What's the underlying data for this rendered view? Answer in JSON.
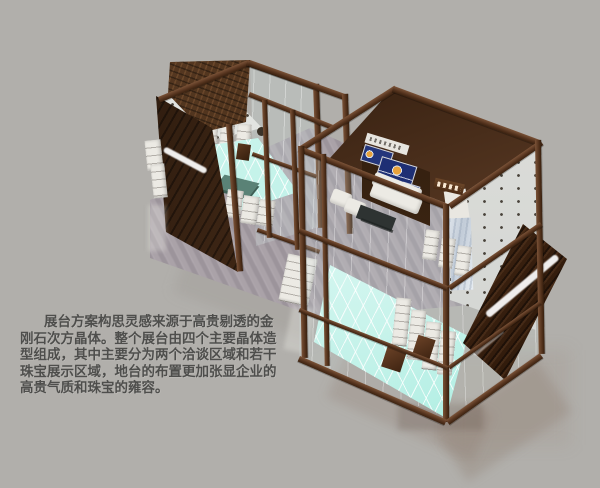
{
  "page": {
    "background": "#b1afab"
  },
  "caption": {
    "color": "#4e4e4c",
    "lines": [
      "展台方案构思灵感来源于高贵剔透的金",
      "刚石次方晶体。整个展台由四个主要晶体造",
      "型组成，其中主要分为两个洽谈区域和若干",
      "珠宝展示区域，地台的布置更加张显企业的",
      "高贵气质和珠宝的雍容。"
    ]
  },
  "scene": {
    "subject": "珠宝展台三维效果图",
    "palette": {
      "frame_bronze": "#5d3b26",
      "dark_timber_wall": "#311d0e",
      "display_white": "#eceae4",
      "lit_floor_cyan": "#c8f2ea",
      "platform_wood_gray": "#a39ba1",
      "poster_blue": "#24367c",
      "table_green": "#5a8276",
      "glass_tint": "rgba(210,224,222,0.25)"
    }
  }
}
